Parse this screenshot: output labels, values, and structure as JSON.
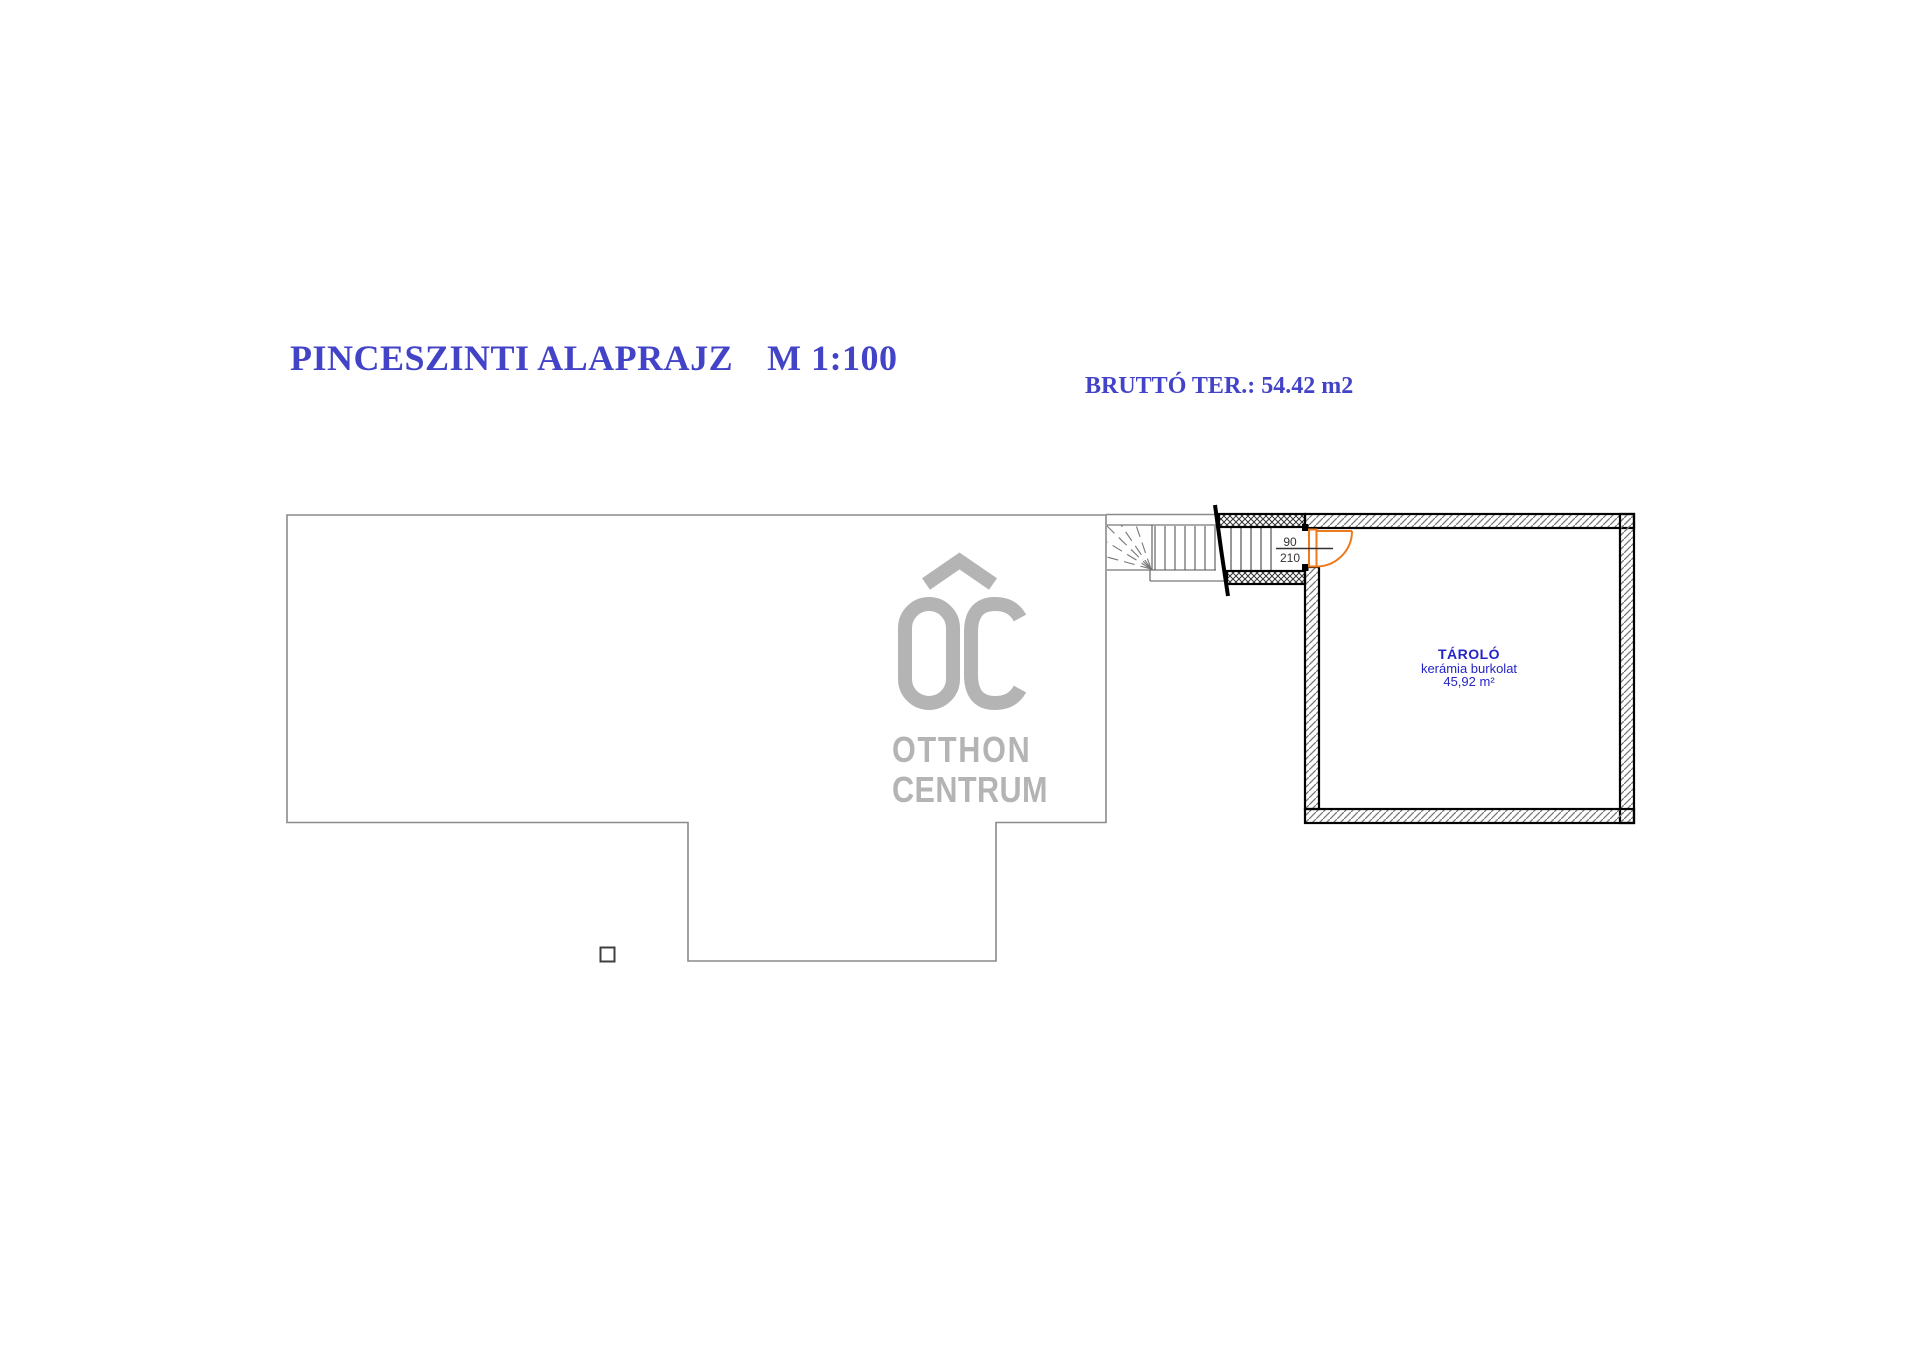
{
  "title": {
    "text": "PINCESZINTI ALAPRAJZ",
    "scale": "M 1:100"
  },
  "area_note": "BRUTTÓ TER.: 54.42 m2",
  "room": {
    "name": "TÁROLÓ",
    "finish": "kerámia burkolat",
    "area": "45,92 m²"
  },
  "door": {
    "width_cm": "90",
    "height_cm": "210"
  },
  "logo": {
    "monogram": "OC",
    "line1": "OTTHON",
    "line2": "CENTRUM"
  },
  "colors": {
    "heading_blue": "#4343c8",
    "label_blue": "#2424c8",
    "door_orange": "#ed7a1d",
    "logo_gray": "#b4b4b4",
    "outline_gray": "#8a8a8a",
    "wall_black": "#000000"
  }
}
